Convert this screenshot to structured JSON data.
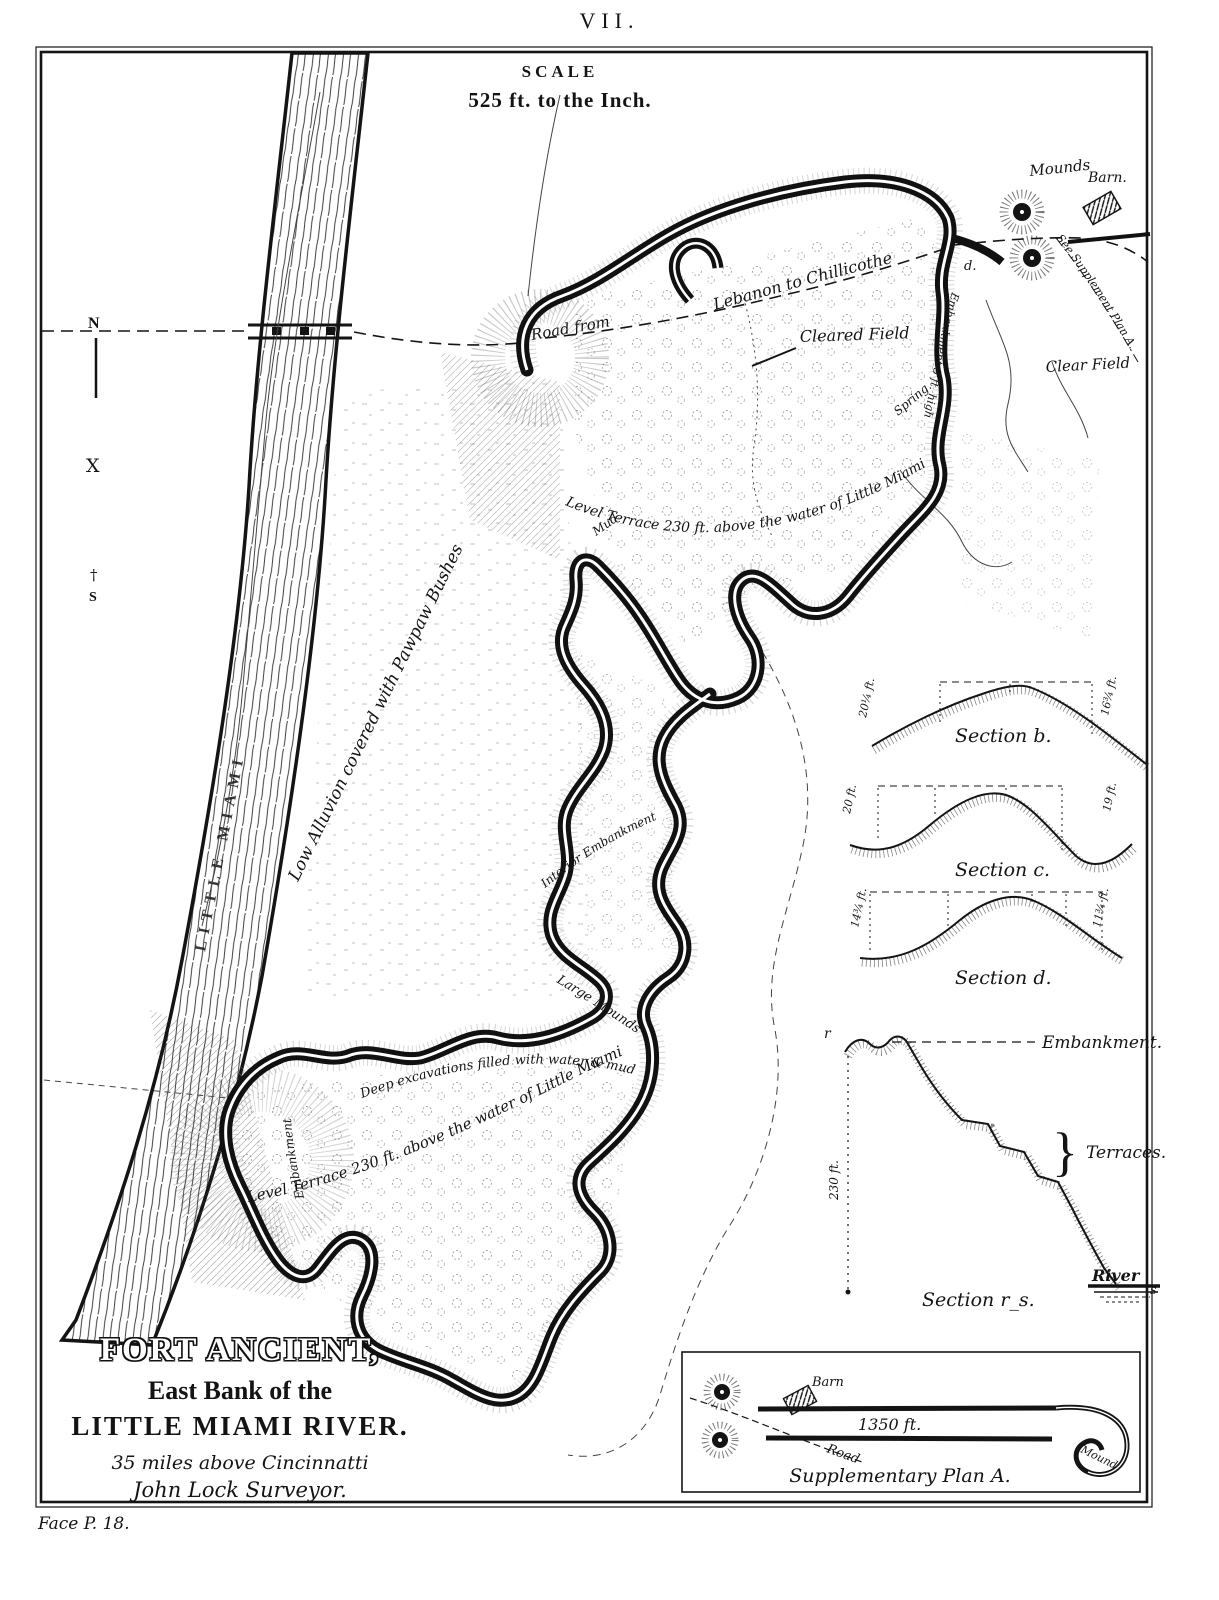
{
  "plate": {
    "number": "VII.",
    "face_note": "Face P. 18."
  },
  "scale": {
    "title": "SCALE",
    "value": "525 ft. to the Inch."
  },
  "compass": {
    "north": "N",
    "x_mark": "X",
    "cross": "†",
    "south": "S"
  },
  "map_labels": {
    "river_name": "LITTLE MIAMI",
    "mounds": "Mounds",
    "barn": "Barn.",
    "see_plan": "See Supplement Plan A.",
    "clear_field": "Clear Field",
    "cleared_field": "Cleared Field",
    "road_from": "Road from",
    "road_dest": "Lebanon to Chillicothe",
    "spring": "Spring",
    "point_d": "d.",
    "embankment_east": "Embankment 3 ft. high",
    "terrace_north": "Level Terrace 230 ft. above the water of Little Miami",
    "mud": "Mud",
    "low_alluvion": "Low Alluvion covered with Pawpaw Bushes",
    "interior_embankment": "Interior Embankment",
    "large_mounds": "Large Mounds",
    "deep_excavations": "Deep excavations filled with water & mud",
    "terrace_south": "Level Terrace 230 ft. above the water of Little Miami",
    "embankment_west": "Embankment"
  },
  "sections": {
    "b": {
      "title": "Section b.",
      "left_height": "20¼ ft.",
      "right_height": "16¾ ft."
    },
    "c": {
      "title": "Section c.",
      "left_height": "20 ft.",
      "right_height": "19 ft."
    },
    "d": {
      "title": "Section d.",
      "left_height": "14¾ ft.",
      "right_height": "11¾ ft."
    },
    "rs": {
      "title": "Section r_s.",
      "point_r": "r",
      "point_s": "s",
      "embankment": "Embankment.",
      "terraces": "Terraces.",
      "river": "River",
      "height": "230 ft."
    }
  },
  "title_block": {
    "title": "FORT ANCIENT,",
    "subtitle1": "East Bank of the",
    "subtitle2": "LITTLE MIAMI RIVER.",
    "note1": "35 miles above Cincinnatti",
    "note2": "John Lock Surveyor."
  },
  "supplementary_plan": {
    "caption": "Supplementary Plan A.",
    "wall_length": "1350 ft.",
    "barn": "Barn",
    "road": "Road",
    "mound": "Mound"
  }
}
